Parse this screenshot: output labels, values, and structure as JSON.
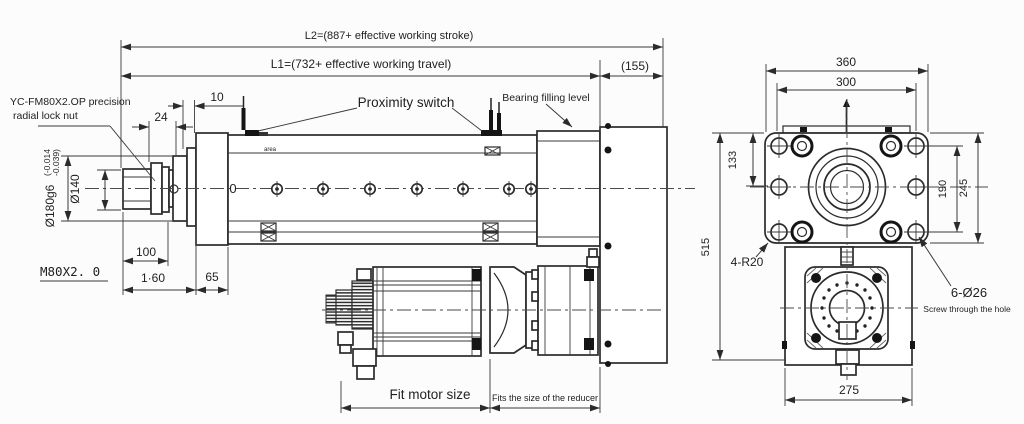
{
  "top_dimensions": {
    "l2": "L2=(887+ effective working stroke)",
    "l1": "L1=(732+ effective working travel)",
    "right_offset": "(155)"
  },
  "left_annotations": {
    "lock_nut_line1": "YC-FM80X2.OP precision",
    "lock_nut_line2": "radial lock nut",
    "thread_label": "M80X2. 0"
  },
  "left_dimensions": {
    "d10": "10",
    "d24": "24",
    "rod_diameter": "Ø140",
    "flange_diameter": "Ø180g6",
    "tolerance_upper": "(-0.014",
    "tolerance_lower": "-0.039)",
    "d100": "100",
    "d160": "1·60",
    "d65": "65"
  },
  "body_annotations": {
    "proximity_switch": "Proximity switch",
    "bearing_filling_level": "Bearing filling level",
    "area_label": "area",
    "stroke_zero": "0"
  },
  "bottom_dimensions": {
    "fit_motor": "Fit motor size",
    "fit_reducer": "Fits the size of the reducer"
  },
  "side_view": {
    "d360": "360",
    "d300": "300",
    "d133": "133",
    "d190": "190",
    "d245": "245",
    "d515": "515",
    "d275": "275",
    "corner_radius": "4-R20",
    "bolt_holes": "6-Ø26",
    "bolt_holes_note": "Screw through the hole"
  },
  "colors": {
    "line": "#2b2b2b",
    "background": "#fcfcfc",
    "text": "#1f1f1f"
  }
}
